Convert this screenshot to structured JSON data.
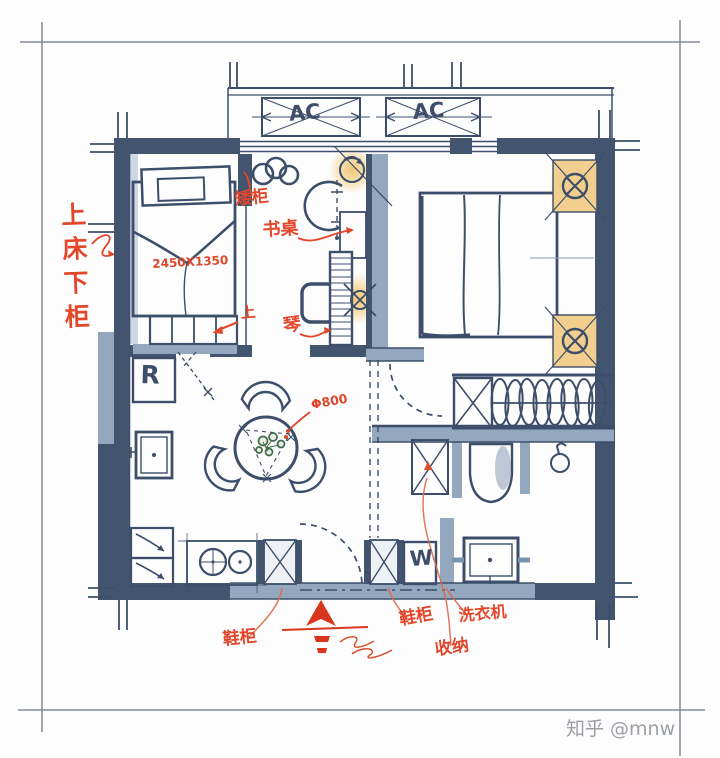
{
  "watermark": "知乎 @mnw",
  "balcony": {
    "ac": [
      "AC",
      "AC"
    ]
  },
  "labels": {
    "bunk_note": "上床下柜",
    "bed_dimension": "2450X1350",
    "low_cabinet": "矮柜",
    "desk": "书桌",
    "piano": "琴",
    "step_up": "上",
    "table_diameter": "Φ800",
    "fridge": "R",
    "washer": "W",
    "shoe_cabinet_entry": "鞋柜",
    "shoe_cabinet_hall": "鞋柜",
    "storage": "收纳",
    "washing_machine": "洗衣机"
  },
  "colors": {
    "wall_dark": "#42546e",
    "wall_light": "#93a7bf",
    "ink": "#3c4e69",
    "annotation_red": "#e2472a",
    "lamp_glow": "#f0c36b",
    "watermark": "#9b9fa4",
    "background": "#fdfdfe"
  }
}
